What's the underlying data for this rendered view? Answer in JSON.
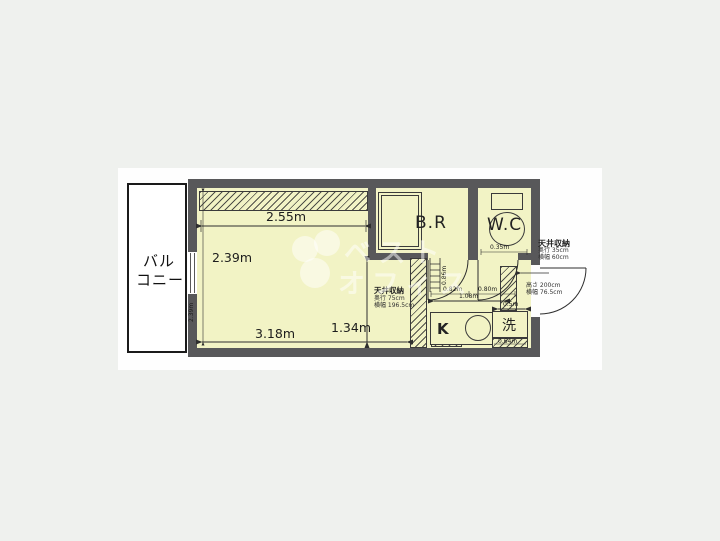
{
  "plan": {
    "balcony": {
      "line1": "バル",
      "line2": "コニー"
    },
    "rooms": {
      "bath": "B.R",
      "wc": "W.C",
      "kitchen": "K",
      "laundry": "洗"
    },
    "dims": {
      "top": "2.55m",
      "room": "2.39m",
      "bottom": "3.18m",
      "lower_right": "1.34m",
      "left_tiny": "2.39m",
      "slide": "0.86m",
      "br_door": "0.82m",
      "wc_door": "0.80m",
      "hall": "1.08m",
      "half": "0.5m",
      "wc_top": "0.35m",
      "laundry_w": "0.64m"
    },
    "storage_room": {
      "title": "天井収納",
      "depth": "奥行 75cm",
      "width": "横幅 196.5cm"
    },
    "storage_entry": {
      "title": "天井収納",
      "depth": "奥行 35cm",
      "width": "横幅 60cm"
    },
    "entry_door": {
      "height": "高さ 200cm",
      "width": "横幅 76.5cm"
    },
    "watermark": {
      "line1": "ベスト",
      "line2": "オフィス"
    }
  },
  "colors": {
    "wall": "#58585a",
    "floor": "#f2f3c5",
    "page": "#eff1ee",
    "card": "#fefefe"
  }
}
